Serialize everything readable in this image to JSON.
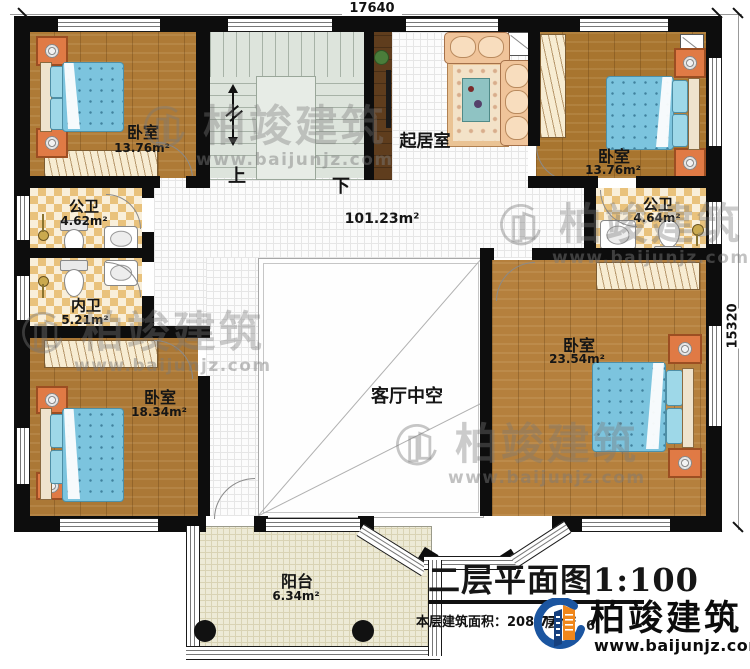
{
  "plan": {
    "dimension_top": "17640",
    "dimension_right": "15320",
    "stair_up": "上",
    "stair_down": "下",
    "hall_area": "101.23m²",
    "rooms": {
      "bedroom_top_left": {
        "name": "卧室",
        "area": "13.76m²"
      },
      "bedroom_top_right": {
        "name": "卧室",
        "area": "13.76m²"
      },
      "bedroom_bottom_left": {
        "name": "卧室",
        "area": "18.34m²"
      },
      "bedroom_right": {
        "name": "卧室",
        "area": "23.54m²"
      },
      "public_bath_left": {
        "name": "公卫",
        "area": "4.62m²"
      },
      "public_bath_right": {
        "name": "公卫",
        "area": "4.64m²"
      },
      "inner_bath": {
        "name": "内卫",
        "area": "5.21m²"
      },
      "living_room": {
        "name": "起居室"
      },
      "living_void": {
        "name": "客厅中空"
      },
      "balcony": {
        "name": "阳台",
        "area": "6.34m²"
      }
    }
  },
  "title_block": {
    "title": "二层平面图1:100",
    "floor_area_label": "本层建筑面积：208.77m²",
    "obscured_fragment_1": "层",
    "obscured_fragment_2": "6"
  },
  "brand": {
    "name": "柏竣建筑",
    "website": "www.baijunjz.com"
  },
  "colors": {
    "wall": "#0d0d0d",
    "wood_floor": "#ae7a36",
    "bath_tile": "#e9c27c",
    "stair": "#dde4dc",
    "balcony_floor": "#edead6",
    "bed": "#7cc4de",
    "sofa": "#f0c49a",
    "nightstand": "#e07a45",
    "logo_blue": "#1b55a0",
    "logo_orange": "#f0871c"
  }
}
